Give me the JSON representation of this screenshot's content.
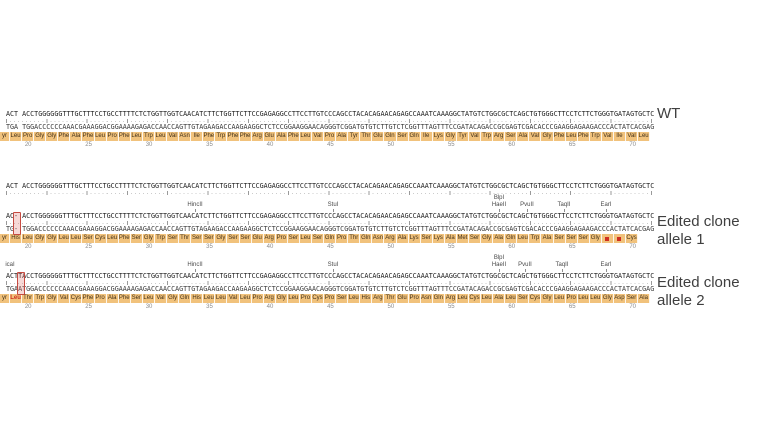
{
  "colors": {
    "strand_text": "#1c1c1c",
    "aa_bg": "#f1c27c",
    "aa_text": "#40301a",
    "stop_red": "#cf2e20",
    "edit_box_border": "#c64a41",
    "label_text": "#3f3f3f",
    "enzyme_text": "#4a4a4a",
    "ruler_text": "#8a8a8a"
  },
  "tracks": {
    "reference": {
      "top_strand": "ACT ACCTGGGGGGTTTGCTTTCCTGCCTTTTCTCTGGTTGGTCAACATCTTCTGGTTCTTCCGAGAGGCCTTCCTTGTCCCAGCCTACACAGAACAGAGCCAAATCAAAGGCTATGTCTGGCGCTCAGCTGTGGGCTTCCTCTTCTGGGTGATAGTGCTC"
    },
    "wt": {
      "label": "WT",
      "top_strand": "ACT ACCTGGGGGGTTTGCTTTCCTGCCTTTTCTCTGGTTGGTCAACATCTTCTGGTTCTTCCGAGAGGCCTTCCTTGTCCCAGCCTACACAGAACAGAGCCAAATCAAAGGCTATGTCTGGCGCTCAGCTGTGGGCTTCCTCTTCTGGGTGATAGTGCTC",
      "bottom_strand": "TGA TGGACCCCCCAAACGAAAGGACGGAAAAGAGACCAACCAGTTGTAGAAGACCAAGAAGGCTCTCCGGAAGGAACAGGGTCGGATGTGTCTTGTCTCGGTTTAGTTTCCGATACAGACCGCGAGTCGACACCCGAAGGAGAAGACCCACTATCACGAG",
      "aa": [
        "yr",
        "Leu",
        "Pro",
        "Gly",
        "Gly",
        "Phe",
        "Ala",
        "Phe",
        "Leu",
        "Pro",
        "Phe",
        "Leu",
        "Trp",
        "Leu",
        "Val",
        "Asn",
        "Ile",
        "Phe",
        "Trp",
        "Phe",
        "Phe",
        "Arg",
        "Glu",
        "Ala",
        "Phe",
        "Leu",
        "Val",
        "Pro",
        "Ala",
        "Tyr",
        "Thr",
        "Glu",
        "Gln",
        "Ser",
        "Gln",
        "Ile",
        "Lys",
        "Gly",
        "Tyr",
        "Val",
        "Trp",
        "Arg",
        "Ser",
        "Ala",
        "Val",
        "Gly",
        "Phe",
        "Leu",
        "Phe",
        "Trp",
        "Val",
        "Ile",
        "Val",
        "Leu"
      ],
      "ruler": [
        20,
        25,
        30,
        35,
        40,
        45,
        50,
        55,
        60,
        65,
        70
      ],
      "enzymes": []
    },
    "allele1": {
      "label_line1": "Edited clone",
      "label_line2": "allele 1",
      "top_strand": "AC- ACCTGGGGGGTTTGCTTTCCTGCCTTTTCTCTGGTTGGTCAACATCTTCTGGTTCTTCCGAGAGGCCTTCCTTGTCCCAGCCTACACAGAACAGAGCCAAATCAAAGGCTATGTCTGGCGCTCAGCTGTGGGCTTCCTCTTCTGGGTGATAGTGCTC",
      "bottom_strand": "TG- TGGACCCCCCAAACGAAAGGACGGAAAAGAGACCAACCAGTTGTAGAAGACCAAGAAGGCTCTCCGGAAGGAACAGGGTCGGATGTGTCTTGTCTCGGTTTAGTTTCCGATACAGACCGCGAGTCGACACCCGAAGGAGAAGACCCACTATCACGAG",
      "aa": [
        "yr",
        "His",
        "Leu",
        "Gly",
        "Gly",
        "Leu",
        "Leu",
        "Ser",
        "Cys",
        "Leu",
        "Phe",
        "Ser",
        "Gly",
        "Trp",
        "Ser",
        "Thr",
        "Ser",
        "Ser",
        "Gly",
        "Ser",
        "Ser",
        "Glu",
        "Arg",
        "Pro",
        "Ser",
        "Leu",
        "Ser",
        "Gln",
        "Pro",
        "Thr",
        "Gln",
        "Asn",
        "Arg",
        "Ala",
        "Lys",
        "Ser",
        "Lys",
        "Ala",
        "Met",
        "Ser",
        "Gly",
        "Ala",
        "Gln",
        "Leu",
        "Trp",
        "Ala",
        "Ser",
        "Ser",
        "Ser",
        "Gly",
        "*",
        "*",
        "Cys"
      ],
      "ruler": [
        20,
        25,
        30,
        35,
        40,
        45,
        50,
        55,
        60,
        65,
        70
      ],
      "enzymes": [
        {
          "name": "HincII",
          "x": 195,
          "row": 1
        },
        {
          "name": "StuI",
          "x": 333,
          "row": 1
        },
        {
          "name": "BlpI",
          "x": 499,
          "row": 0
        },
        {
          "name": "HaeII",
          "x": 499,
          "row": 1
        },
        {
          "name": "PvuII",
          "x": 527,
          "row": 1
        },
        {
          "name": "TaqII",
          "x": 564,
          "row": 1
        },
        {
          "name": "EarI",
          "x": 606,
          "row": 1
        }
      ],
      "edit": {
        "kind": "deletion",
        "column": 3
      }
    },
    "allele2": {
      "label_line1": "Edited clone",
      "label_line2": "allele 2",
      "top_strand": "ACTTACCTGGGGGGTTTGCTTTCCTGCCTTTTCTCTGGTTGGTCAACATCTTCTGGTTCTTCCGAGAGGCCTTCCTTGTCCCAGCCTACACAGAACAGAGCCAAATCAAAGGCTATGTCTGGCGCTCAGCTGTGGGCTTCCTCTTCTGGGTGATAGTGCTC",
      "bottom_strand": "TGAATGGACCCCCCAAACGAAAGGACGGAAAAGAGACCAACCAGTTGTAGAAGACCAAGAAGGCTCTCCGGAAGGAACAGGGTCGGATGTGTCTTGTCTCGGTTTAGTTTCCGATACAGACCGCGAGTCGACACCCGAAGGAGAAGACCCACTATCACGAG",
      "aa": [
        "yr",
        "Leu",
        "Thr",
        "Trp",
        "Gly",
        "Val",
        "Cys",
        "Phe",
        "Pro",
        "Ala",
        "Phe",
        "Ser",
        "Leu",
        "Val",
        "Gly",
        "Gln",
        "His",
        "Leu",
        "Leu",
        "Val",
        "Leu",
        "Pro",
        "Arg",
        "Gly",
        "Leu",
        "Pro",
        "Cys",
        "Pro",
        "Ser",
        "Leu",
        "His",
        "Arg",
        "Thr",
        "Glu",
        "Pro",
        "Asn",
        "Gln",
        "Arg",
        "Leu",
        "Cys",
        "Leu",
        "Ala",
        "Leu",
        "Ser",
        "Cys",
        "Gly",
        "Leu",
        "Pro",
        "Leu",
        "Leu",
        "Gly",
        "Asp",
        "Ser",
        "Ala"
      ],
      "red_aa_indices": [
        1
      ],
      "ruler": [
        20,
        25,
        30,
        35,
        40,
        45,
        50,
        55,
        60,
        65,
        70
      ],
      "enzymes": [
        {
          "name": "icaI",
          "x": 10,
          "row": 1
        },
        {
          "name": "HincII",
          "x": 195,
          "row": 1
        },
        {
          "name": "StuI",
          "x": 333,
          "row": 1
        },
        {
          "name": "BlpI",
          "x": 499,
          "row": 0
        },
        {
          "name": "HaeII",
          "x": 499,
          "row": 1
        },
        {
          "name": "PvuII",
          "x": 525,
          "row": 1
        },
        {
          "name": "TaqII",
          "x": 562,
          "row": 1
        },
        {
          "name": "EarI",
          "x": 606,
          "row": 1
        }
      ],
      "edit": {
        "kind": "insertion",
        "column": 4
      }
    }
  }
}
